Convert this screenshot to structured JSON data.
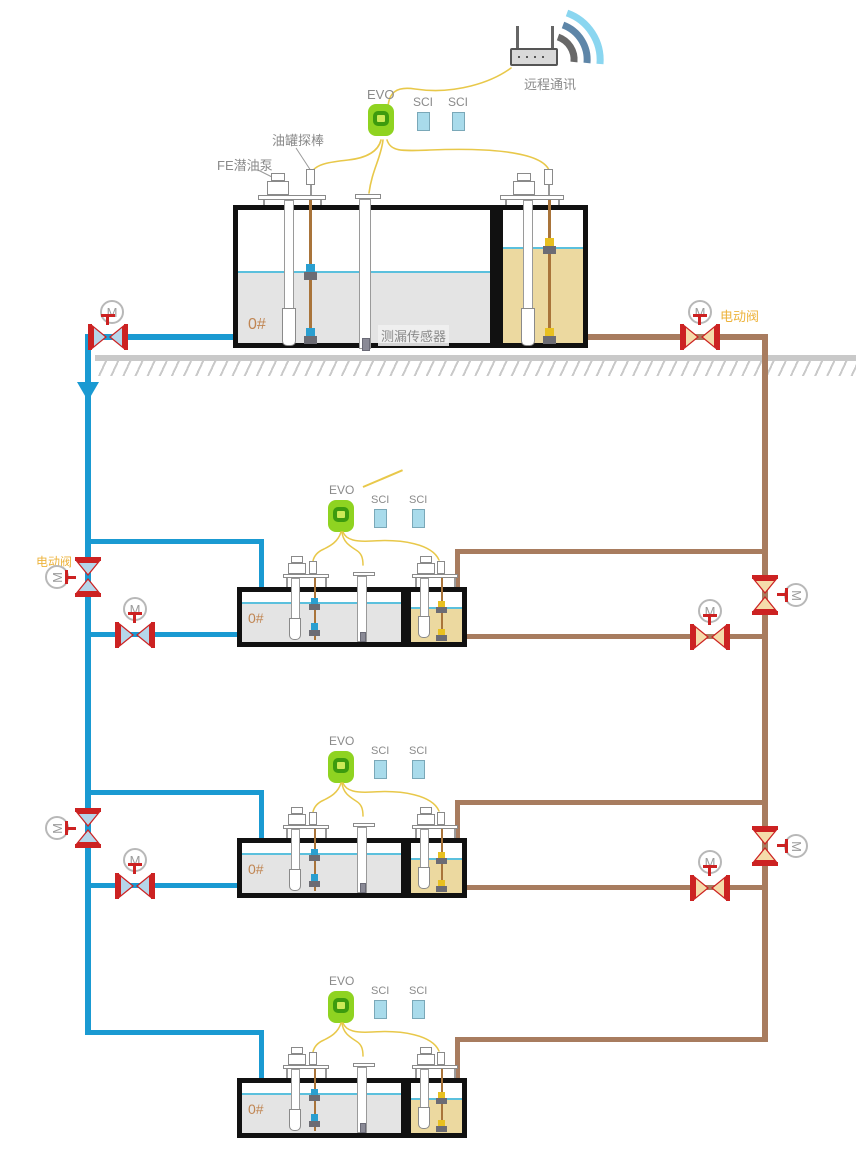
{
  "labels": {
    "remote_comm": "远程通讯",
    "evo": "EVO",
    "sci": "SCI",
    "tank_probe": "油罐探棒",
    "fe_pump": "FE潜油泵",
    "leak_sensor": "测漏传感器",
    "electric_valve": "电动阀",
    "motor": "M",
    "oil_grade": "0#"
  },
  "colors": {
    "pipe_blue": "#1a9ad2",
    "pipe_brown": "#a87c5f",
    "valve_red": "#cc2222",
    "valve_fill_blue": "#b5d6ea",
    "valve_fill_tan": "#f5dcab",
    "wire_yellow": "#e8c84a",
    "evo_green": "#8fd321",
    "evo_ring": "#3d9b0e",
    "evo_core": "#cdea57",
    "sci_fill": "#a9dbeb",
    "liquid_gray": "#e4e4e4",
    "liquid_tan": "#ecd9a0",
    "level_line": "#5bc0dd",
    "ground_gray": "#c9c9c9",
    "label_gray": "#8a8a8a",
    "label_orange": "#c08552",
    "valve_label_yellow": "#edb33c"
  },
  "stations": [
    {
      "id": 1,
      "grade": "0#",
      "has_leak_sensor_label": true
    },
    {
      "id": 2,
      "grade": "0#"
    },
    {
      "id": 3,
      "grade": "0#"
    },
    {
      "id": 4,
      "grade": "0#"
    }
  ]
}
